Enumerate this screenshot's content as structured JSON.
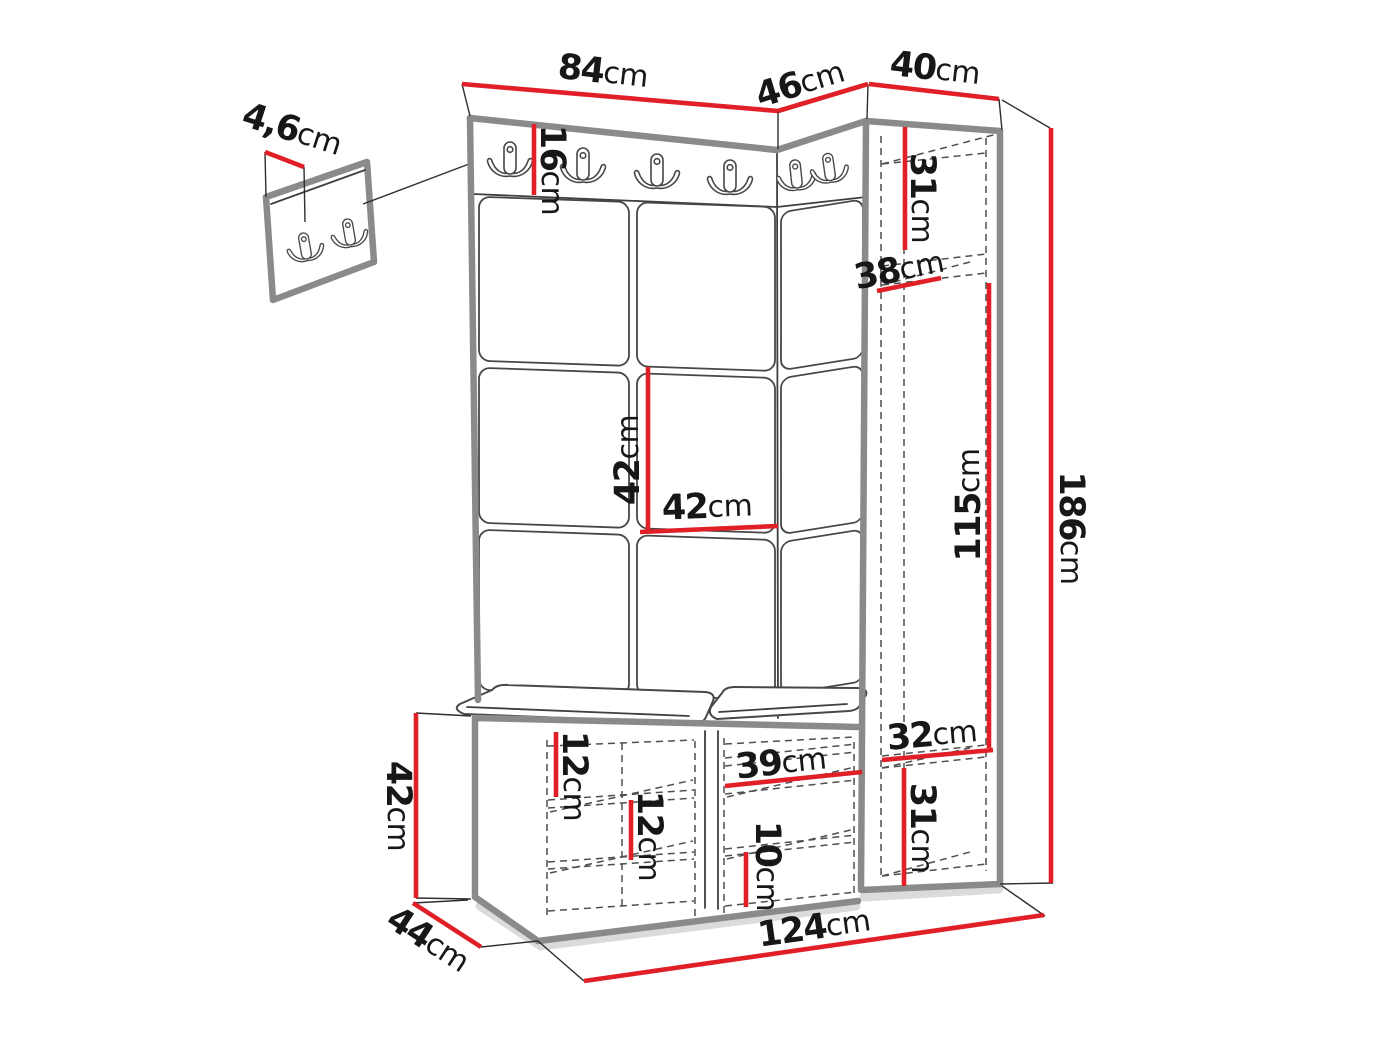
{
  "diagram": {
    "kind": "furniture dimension drawing",
    "subject": "hallway set: hook panel, upholstered wall tiles, tall corner cabinet and shoe bench"
  },
  "dims": {
    "detail_panel_thickness": {
      "value": "4,6",
      "unit": "cm"
    },
    "top_panel_width": {
      "value": "84",
      "unit": "cm"
    },
    "top_corner_width": {
      "value": "46",
      "unit": "cm"
    },
    "top_cabinet_width": {
      "value": "40",
      "unit": "cm"
    },
    "hook_strip_height": {
      "value": "16",
      "unit": "cm"
    },
    "cabinet_top_shelf_height": {
      "value": "31",
      "unit": "cm"
    },
    "cabinet_shelf_depth": {
      "value": "38",
      "unit": "cm"
    },
    "tile_height": {
      "value": "42",
      "unit": "cm"
    },
    "tile_width": {
      "value": "42",
      "unit": "cm"
    },
    "cabinet_middle_height": {
      "value": "115",
      "unit": "cm"
    },
    "total_height": {
      "value": "186",
      "unit": "cm"
    },
    "cabinet_niche_width": {
      "value": "32",
      "unit": "cm"
    },
    "cabinet_bottom_shelf_height": {
      "value": "31",
      "unit": "cm"
    },
    "bench_top_shelf_gap": {
      "value": "12",
      "unit": "cm"
    },
    "bench_mid_shelf_gap": {
      "value": "12",
      "unit": "cm"
    },
    "bench_right_width": {
      "value": "39",
      "unit": "cm"
    },
    "bench_bottom_shelf_gap": {
      "value": "10",
      "unit": "cm"
    },
    "bench_height": {
      "value": "42",
      "unit": "cm"
    },
    "bench_depth": {
      "value": "44",
      "unit": "cm"
    },
    "total_width": {
      "value": "124",
      "unit": "cm"
    }
  }
}
